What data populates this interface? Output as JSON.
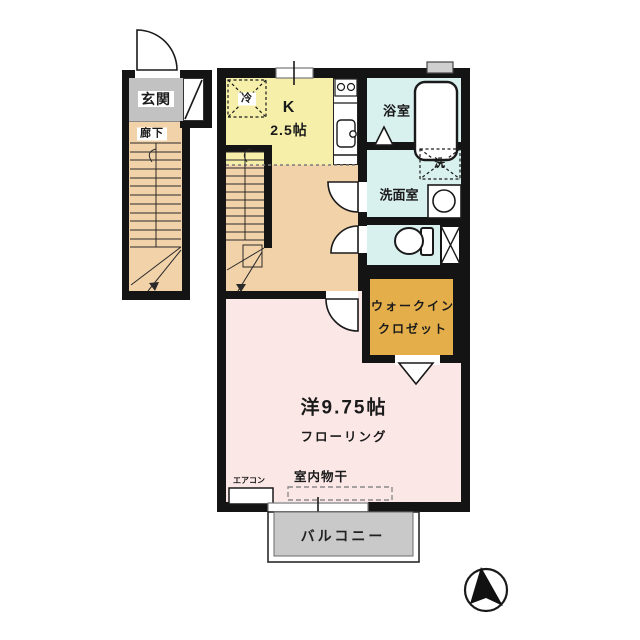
{
  "plan_type": "floor-plan",
  "rooms": {
    "entrance": {
      "label": "玄関"
    },
    "corridor": {
      "label": "廊下"
    },
    "kitchen": {
      "type_label": "K",
      "size_label": "2.5帖",
      "fridge_label": "冷"
    },
    "bathroom": {
      "label": "浴室"
    },
    "washroom": {
      "label": "洗面室",
      "washer_label": "洗"
    },
    "walk_in_closet": {
      "label_line1": "ウォークイン",
      "label_line2": "クロゼット"
    },
    "western_room": {
      "label": "洋9.75帖",
      "flooring_label": "フローリング",
      "indoor_laundry_label": "室内物干",
      "aircon_label": "エアコン"
    },
    "balcony": {
      "label": "バルコニー"
    }
  },
  "colors": {
    "kitchen": "#f6efa9",
    "hall": "#f1d2a9",
    "wet_area": "#d8f0ee",
    "closet": "#e4af4b",
    "western_room": "#fbe7e5",
    "balcony": "#c9c9c9",
    "entrance": "#c3c2c2",
    "wall": "#141414"
  }
}
